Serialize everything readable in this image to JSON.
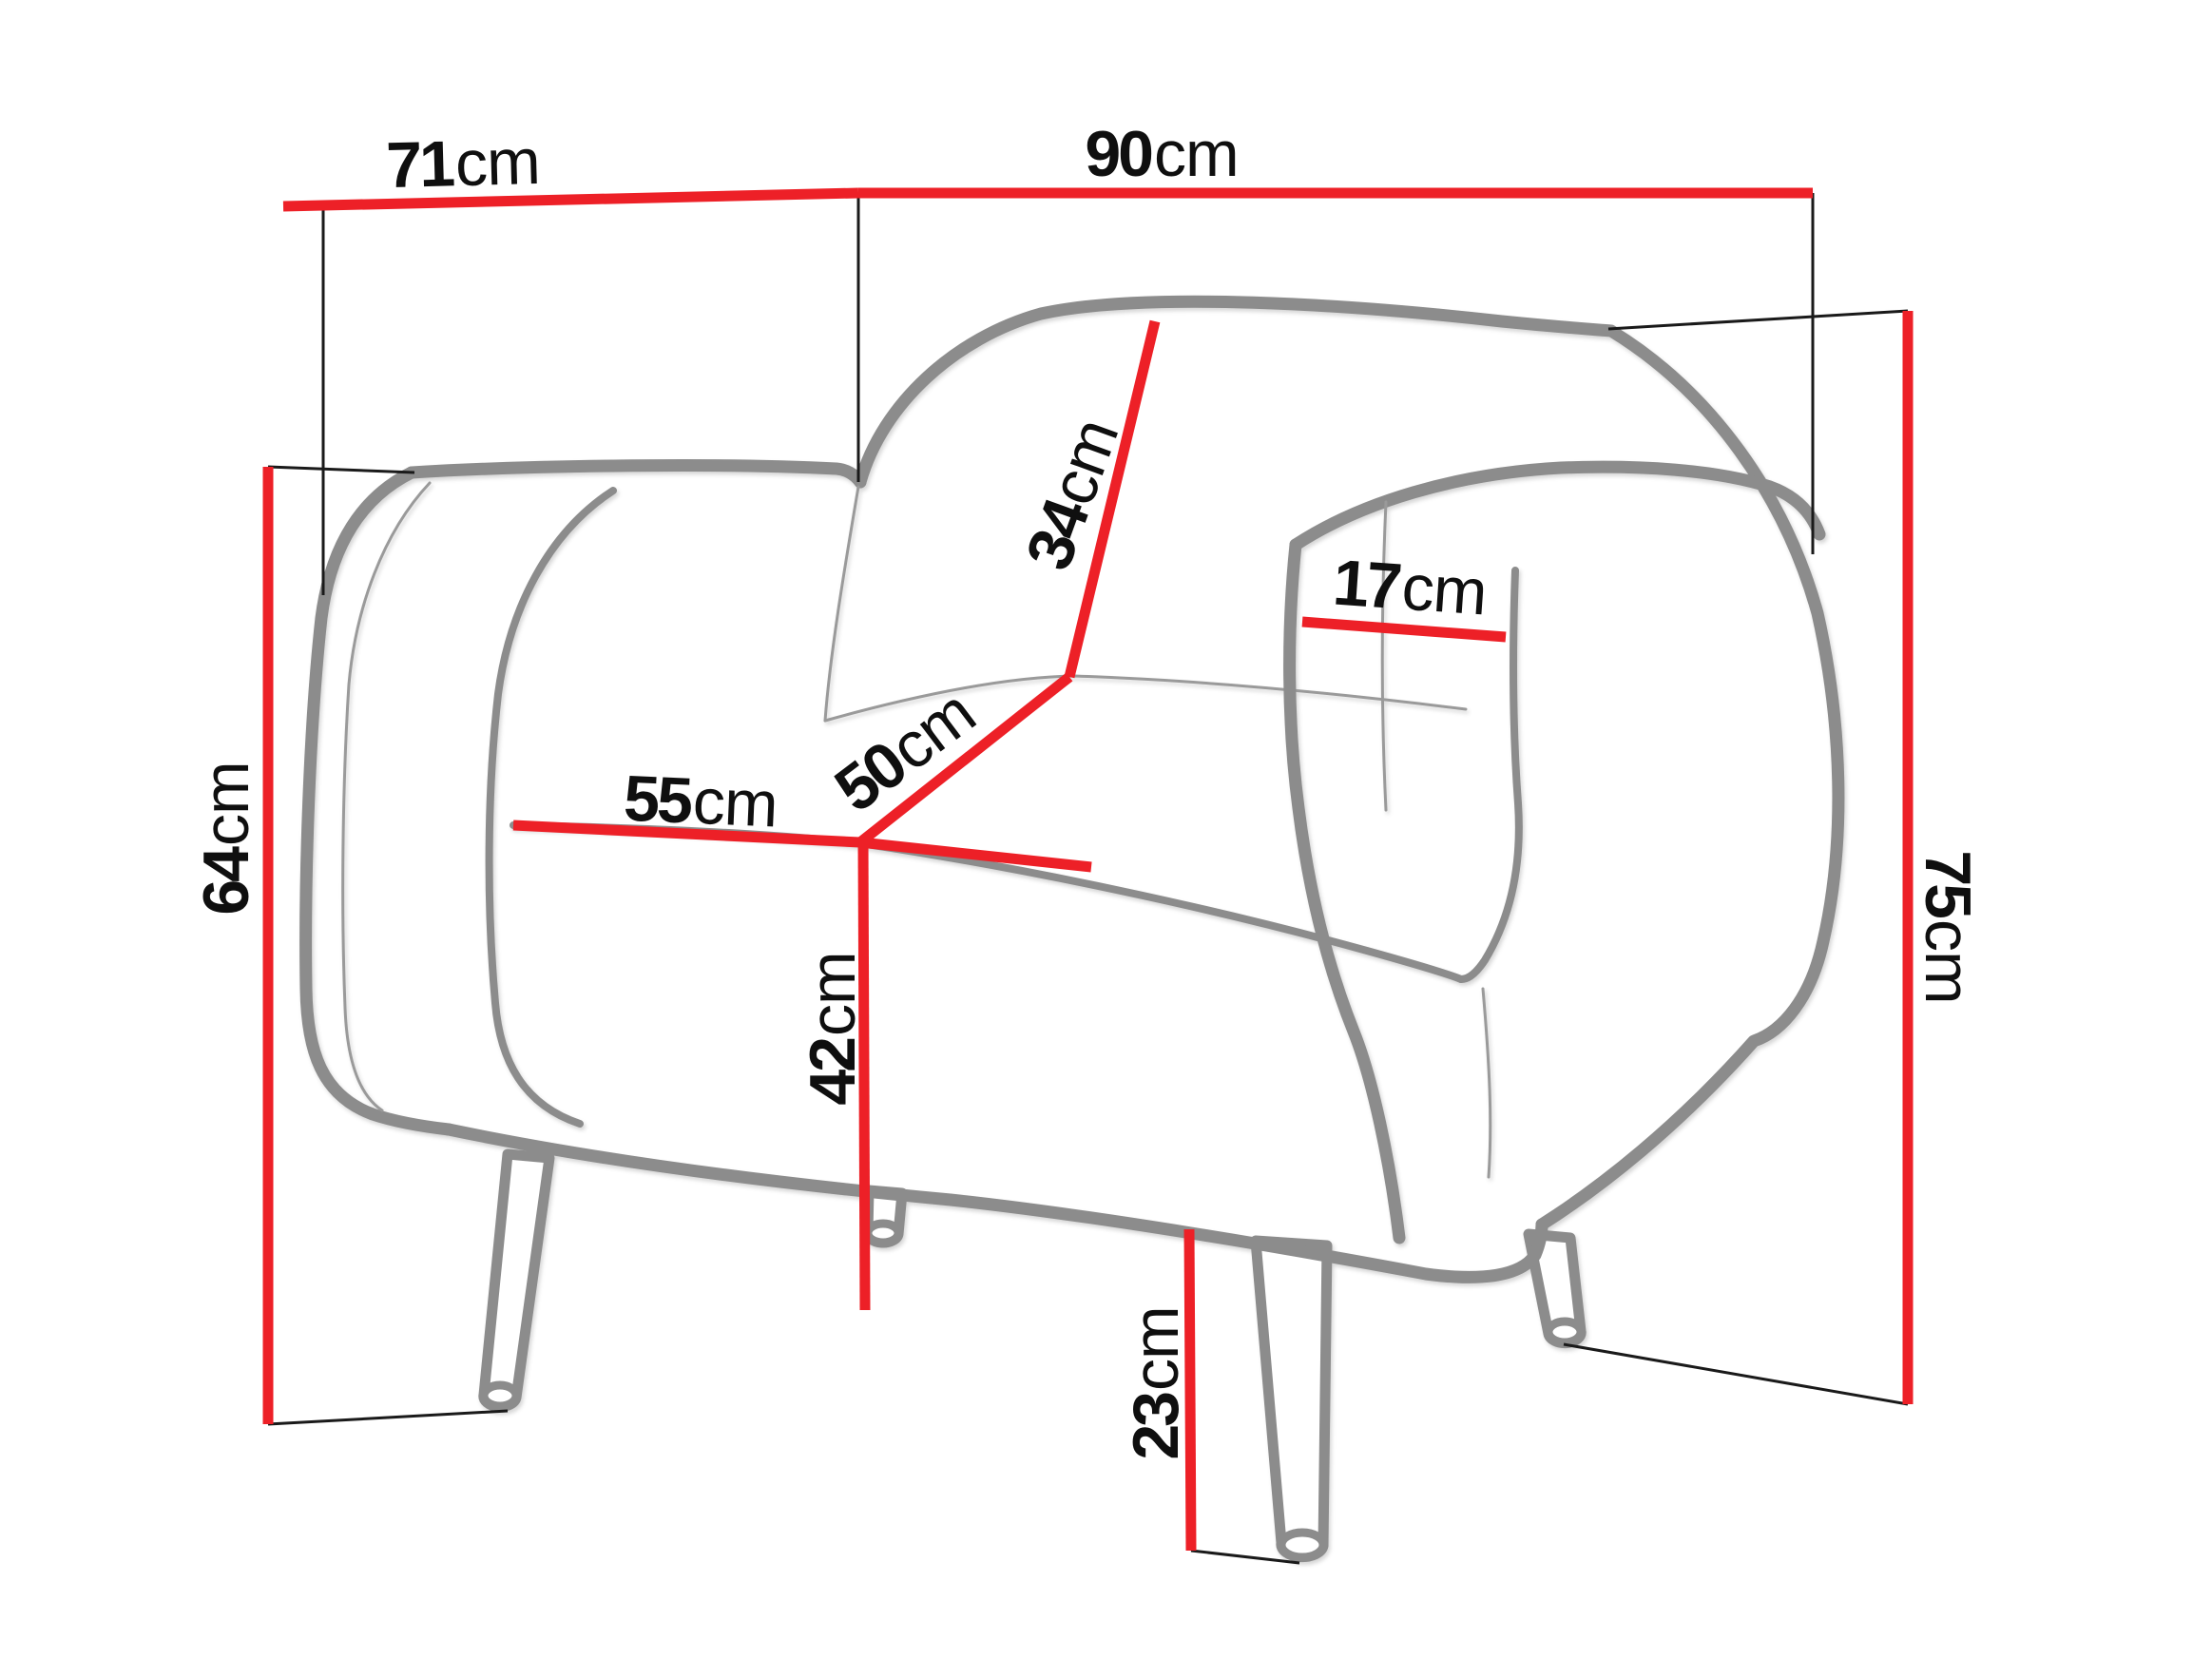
{
  "diagram": {
    "subject": "armchair-dimension-diagram",
    "unit": "cm",
    "colors": {
      "dimension_line": "#ed2027",
      "reference_line": "#1a1a1a",
      "chair_outline": "#8c8c8c",
      "label_text": "#0f0f0f",
      "background": "#ffffff"
    },
    "dimensions": {
      "d71": {
        "value": "71",
        "unit": "cm"
      },
      "d90": {
        "value": "90",
        "unit": "cm"
      },
      "d64": {
        "value": "64",
        "unit": "cm"
      },
      "d75": {
        "value": "75",
        "unit": "cm"
      },
      "d55": {
        "value": "55",
        "unit": "cm"
      },
      "d50": {
        "value": "50",
        "unit": "cm"
      },
      "d34": {
        "value": "34",
        "unit": "cm"
      },
      "d17": {
        "value": "17",
        "unit": "cm"
      },
      "d42": {
        "value": "42",
        "unit": "cm"
      },
      "d23": {
        "value": "23",
        "unit": "cm"
      }
    }
  }
}
